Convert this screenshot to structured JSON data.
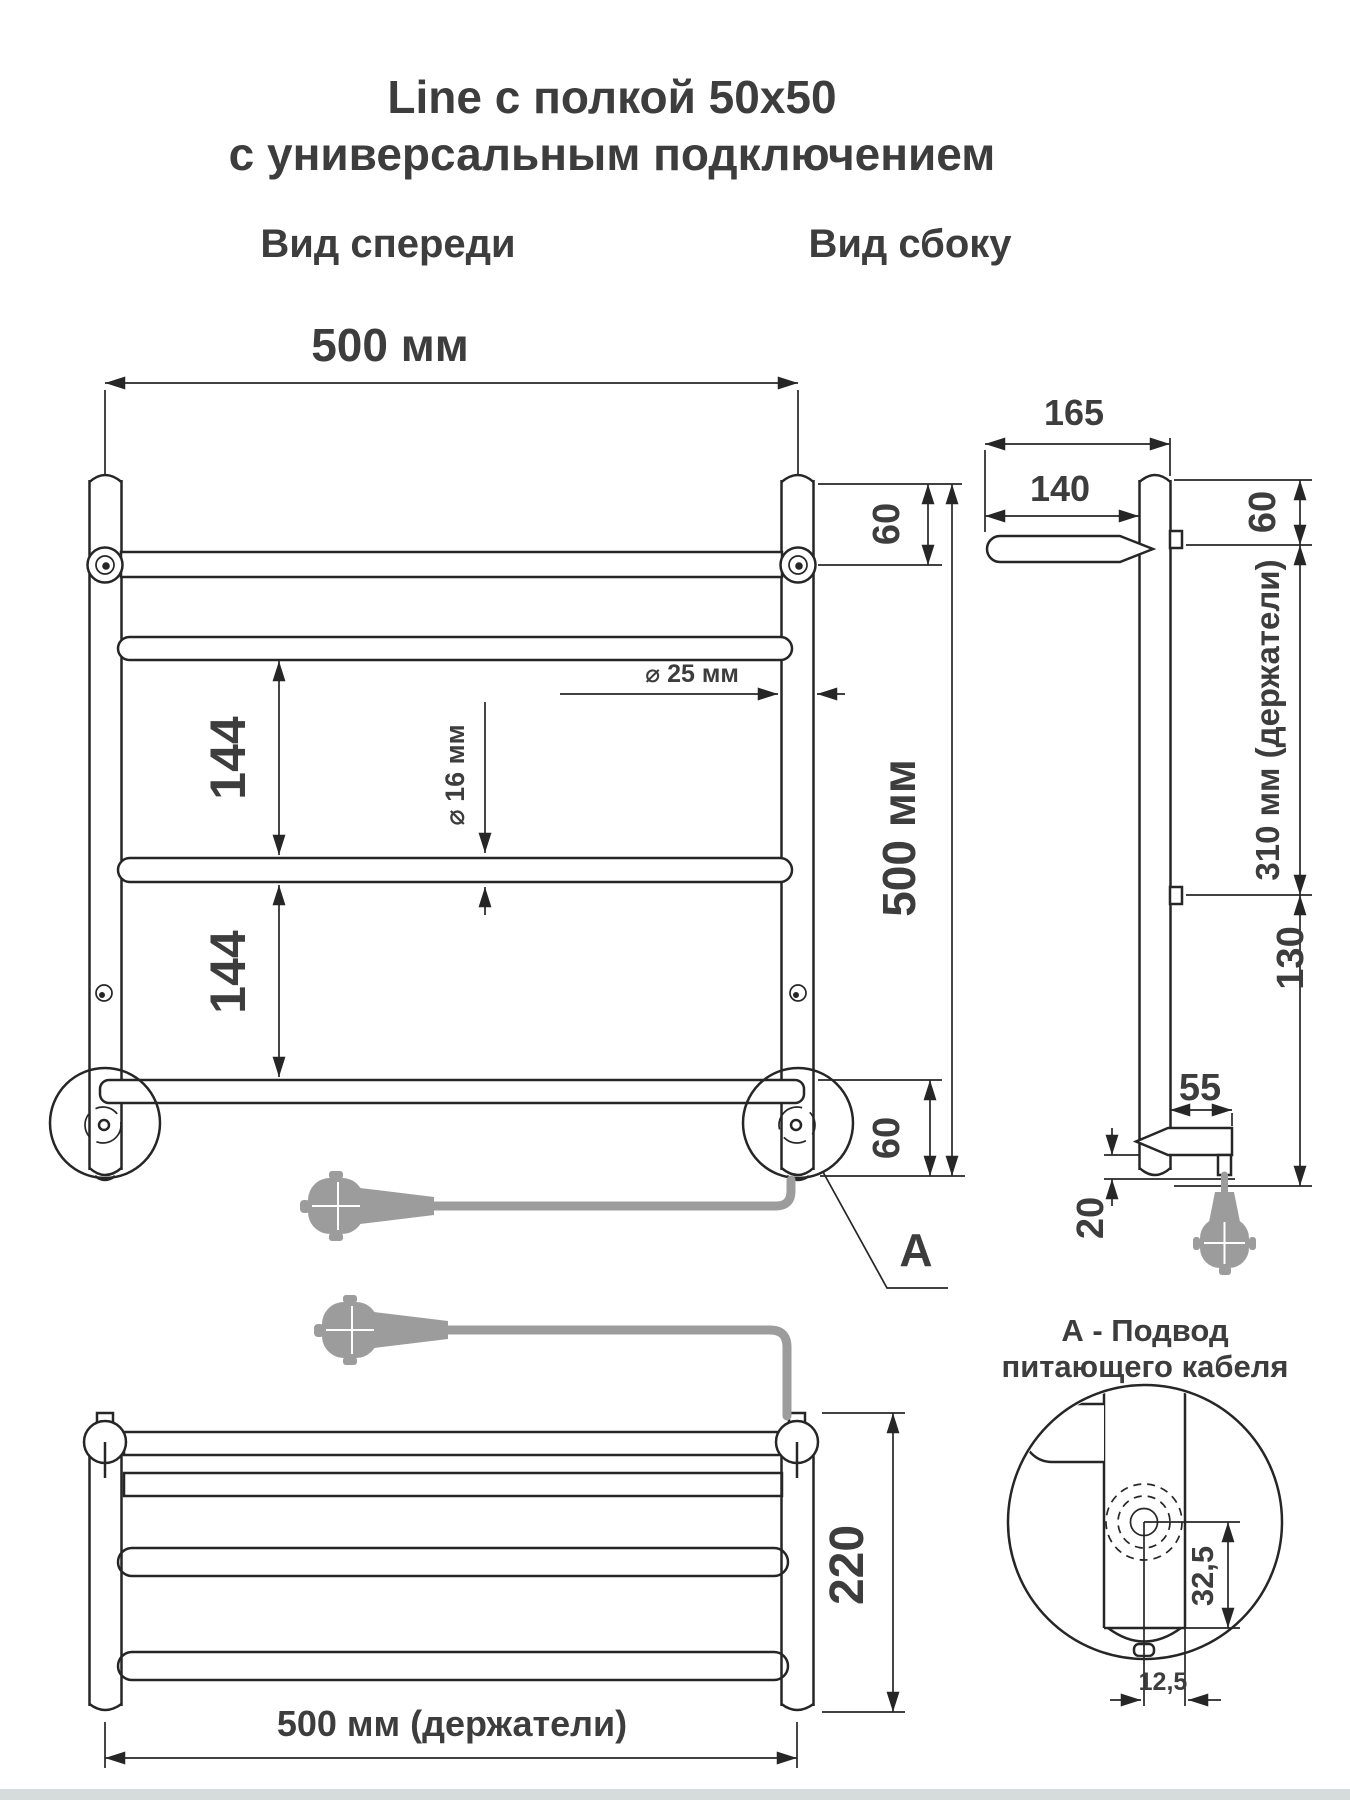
{
  "title": {
    "line1": "Line с полкой 50x50",
    "line2": "с универсальным подключением"
  },
  "front_view": {
    "label": "Вид спереди",
    "width_dim": "500 мм",
    "height_dim": "500 мм",
    "top_offset_dim": "60",
    "bottom_offset_dim": "60",
    "rail_gap_upper_dim": "144",
    "rail_gap_lower_dim": "144",
    "rail_diameter_dim": "⌀ 16 мм",
    "post_diameter_dim": "⌀ 25 мм",
    "callout_letter": "А"
  },
  "side_view": {
    "label": "Вид сбоку",
    "depth_total_dim": "165",
    "shelf_depth_dim": "140",
    "top_offset_dim": "60",
    "holders_span_dim": "310 мм (держатели)",
    "bottom_span_dim": "130",
    "bottom_arm_dim": "55",
    "cable_offset_dim": "20"
  },
  "top_view": {
    "depth_dim": "220",
    "holders_width_dim": "500 мм (держатели)"
  },
  "detail_view": {
    "note_line1": "А - Подвод",
    "note_line2": "питающего кабеля",
    "vertical_dim": "32,5",
    "horizontal_dim": "12,5"
  }
}
